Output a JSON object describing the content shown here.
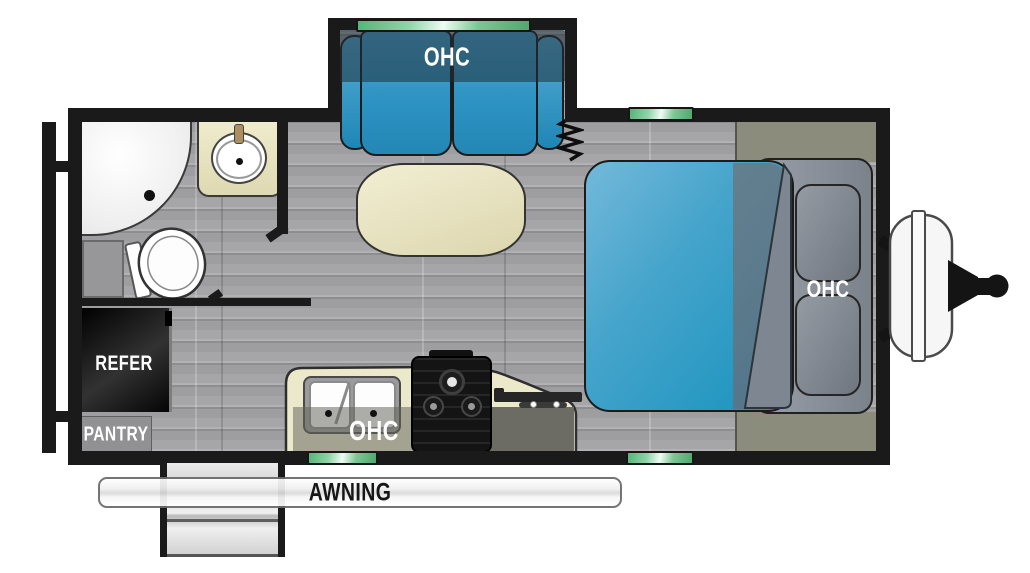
{
  "labels": {
    "sofa_ohc": "OHC",
    "kitchen_ohc": "OHC",
    "bed_ohc": "OHC",
    "refrigerator": "REFER",
    "pantry": "PANTRY",
    "awning": "AWNING"
  },
  "colors": {
    "wall": "#1a1a1a",
    "floor_gray": "#a6a6a9",
    "sofa_blue": "#3aa0cf",
    "bed_blue": "#2d9ec7",
    "bed_blanket_slate": "#5b7b8f",
    "counter_cream": "#ece8ca",
    "cabinet_gray": "#8d939b",
    "olive_shelf": "#8c8c7d",
    "window_green": "#6fc28c",
    "refrigerator_black": "#161616",
    "pantry_gray": "#919194",
    "awning_white": "#f5f5f5"
  },
  "furniture": [
    "slide-out-sofa",
    "dinette-table",
    "bed",
    "bed-wardrobe-ohc",
    "shower",
    "toilet",
    "bathroom-sink",
    "double-kitchen-sink",
    "cooktop",
    "flip-up-counter",
    "refrigerator",
    "pantry",
    "entry-steps",
    "awning",
    "window",
    "propane-tanks",
    "tongue-hitch"
  ]
}
